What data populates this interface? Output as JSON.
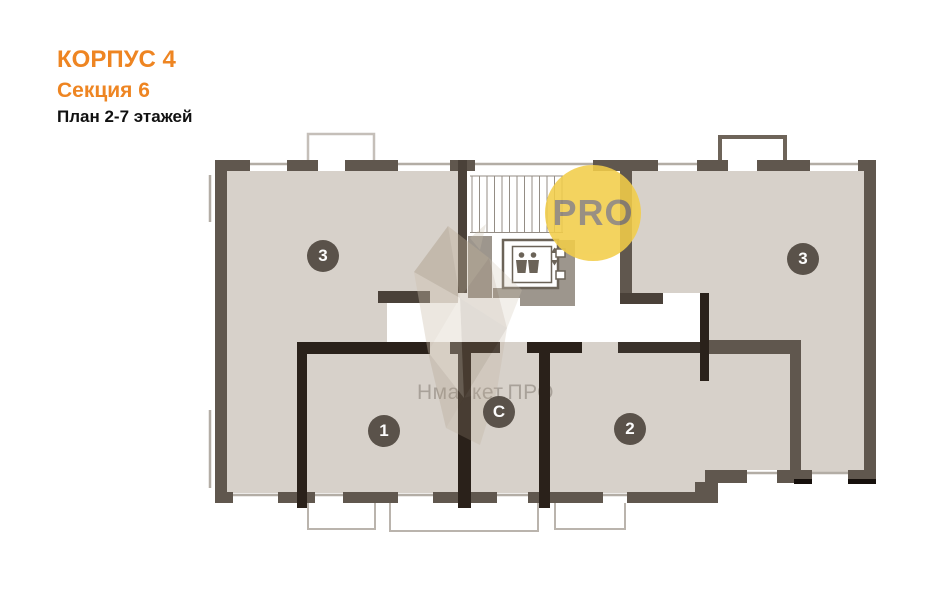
{
  "header": {
    "building": "КОРПУС 4",
    "section": "Секция 6",
    "plan_label": "План 2-7 этажей"
  },
  "floorplan": {
    "rooms": [
      {
        "id": "room-3-left",
        "label": "3"
      },
      {
        "id": "room-3-right",
        "label": "3"
      },
      {
        "id": "room-1",
        "label": "1"
      },
      {
        "id": "room-studio",
        "label": "С"
      },
      {
        "id": "room-2",
        "label": "2"
      }
    ],
    "core": {
      "elevator_icon": "elevator-passengers-icon",
      "stairs_icon": "staircase-treads"
    }
  },
  "watermarks": {
    "badge": "PRO",
    "brand": "Нмаркет.ПРО",
    "logo_icon": "crystal-facets-icon"
  },
  "colors": {
    "accent": "#ee8522",
    "title_text": "#111111",
    "room_fill": "#d7d1ca",
    "wall_outer": "#60574e",
    "wall_inner": "#2a211a",
    "wall_mid": "#4a4139",
    "shaft_gray": "#9d968d",
    "thin_line": "#b3ada5",
    "balcony_dark": "#6e6459",
    "label_bg": "#544c44",
    "pro_fill": "#f2cd49",
    "pro_text": "#8b8173",
    "brand_text": "#8c857c"
  }
}
